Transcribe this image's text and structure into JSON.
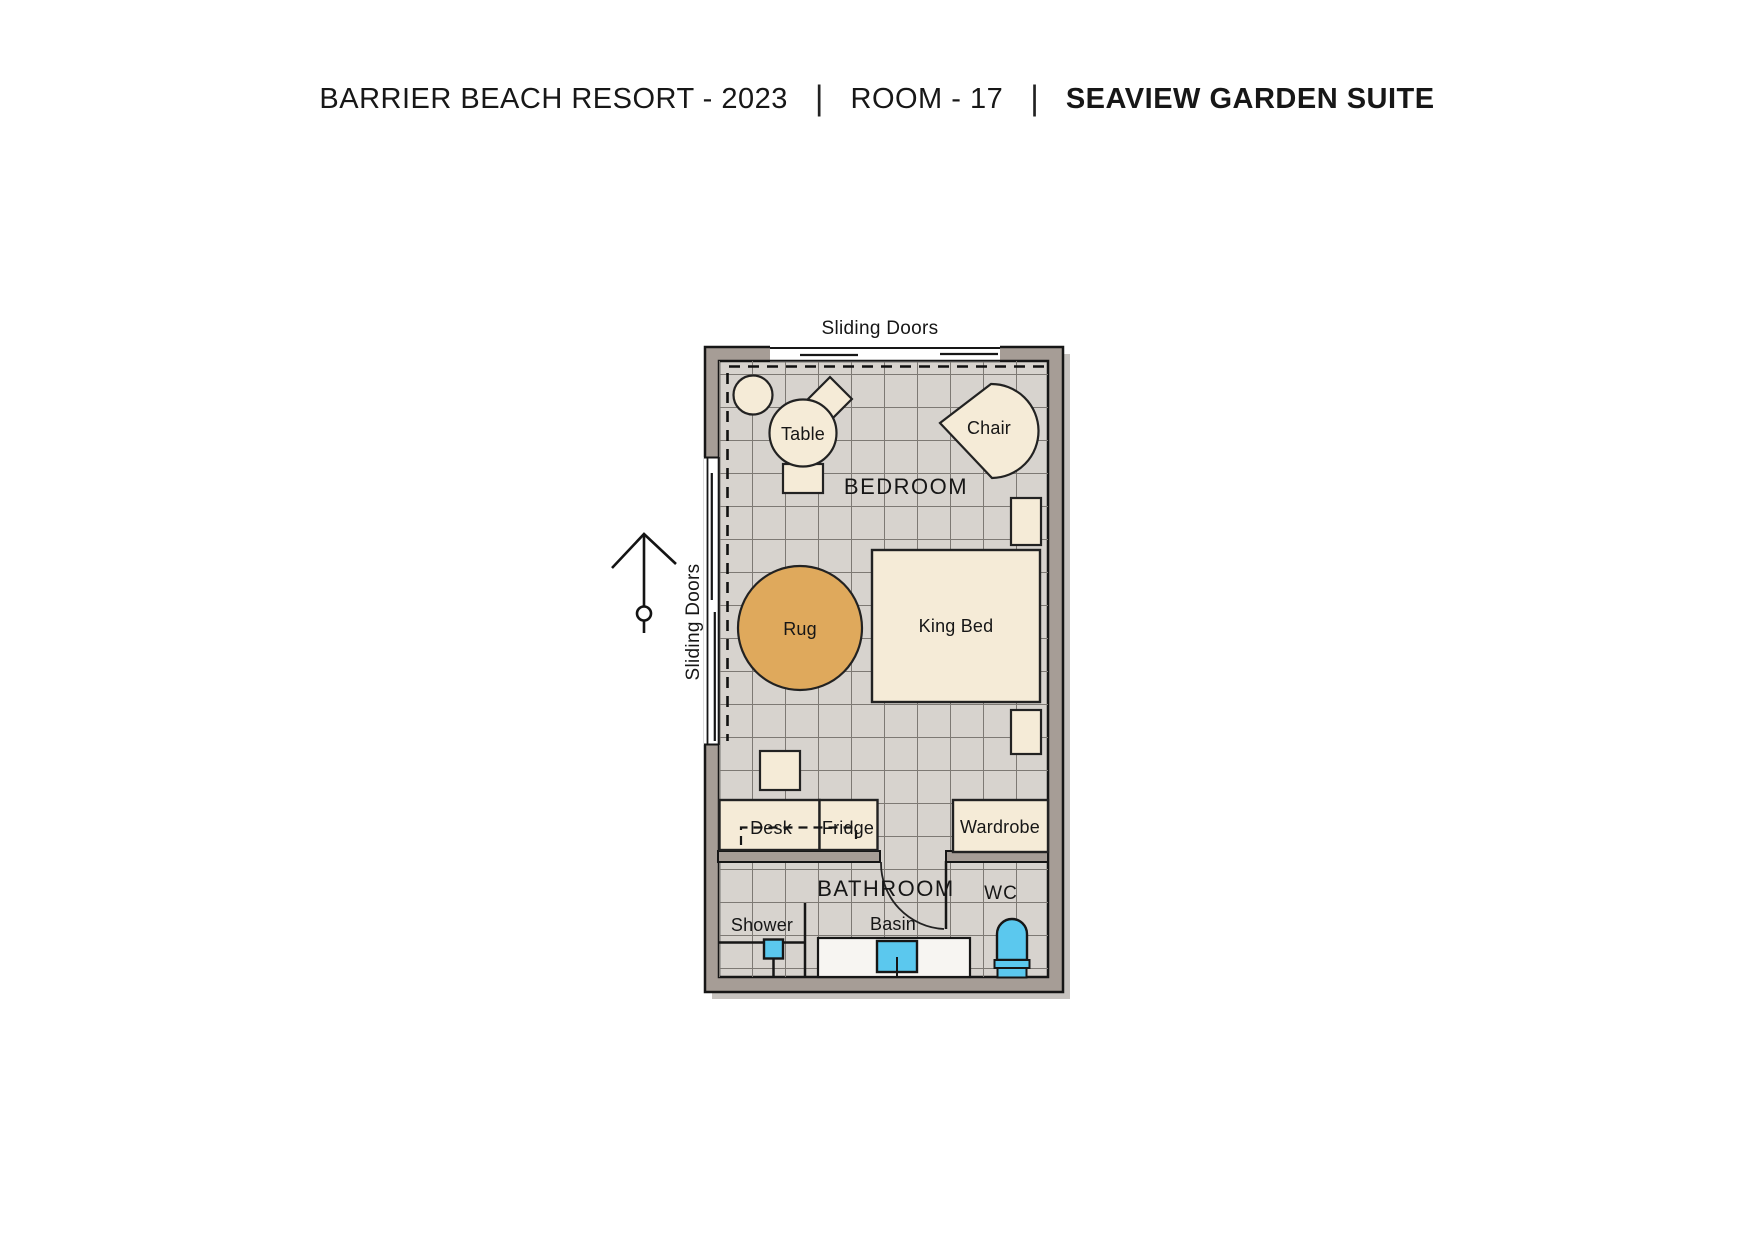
{
  "header": {
    "resort": "BARRIER BEACH RESORT - 2023",
    "separator": "|",
    "room": "ROOM - 17",
    "suite": "SEAVIEW GARDEN SUITE"
  },
  "plan": {
    "labels": {
      "sliding_doors_top": "Sliding Doors",
      "sliding_doors_left": "Sliding Doors",
      "bedroom": "BEDROOM",
      "bathroom": "BATHROOM"
    },
    "furniture": {
      "table": "Table",
      "chair": "Chair",
      "rug": "Rug",
      "king_bed": "King Bed",
      "desk": "Desk",
      "fridge": "Fridge",
      "wardrobe": "Wardrobe",
      "shower": "Shower",
      "basin": "Basin",
      "wc": "WC"
    },
    "rooms": [
      {
        "name": "BEDROOM",
        "furniture": [
          "Table",
          "Chair",
          "Rug",
          "King Bed",
          "Desk",
          "Fridge",
          "Wardrobe"
        ]
      },
      {
        "name": "BATHROOM",
        "furniture": [
          "Shower",
          "Basin"
        ]
      },
      {
        "name": "WC",
        "furniture": []
      }
    ],
    "colors": {
      "wall": "#a69d96",
      "floor": "#d7d3ce",
      "grid_line": "#7d7974",
      "furniture": "#f5ebd7",
      "rug": "#dfa95c",
      "fixture_blue": "#5bc8ee",
      "counter": "#f7f5f2",
      "outline": "#161616"
    }
  }
}
